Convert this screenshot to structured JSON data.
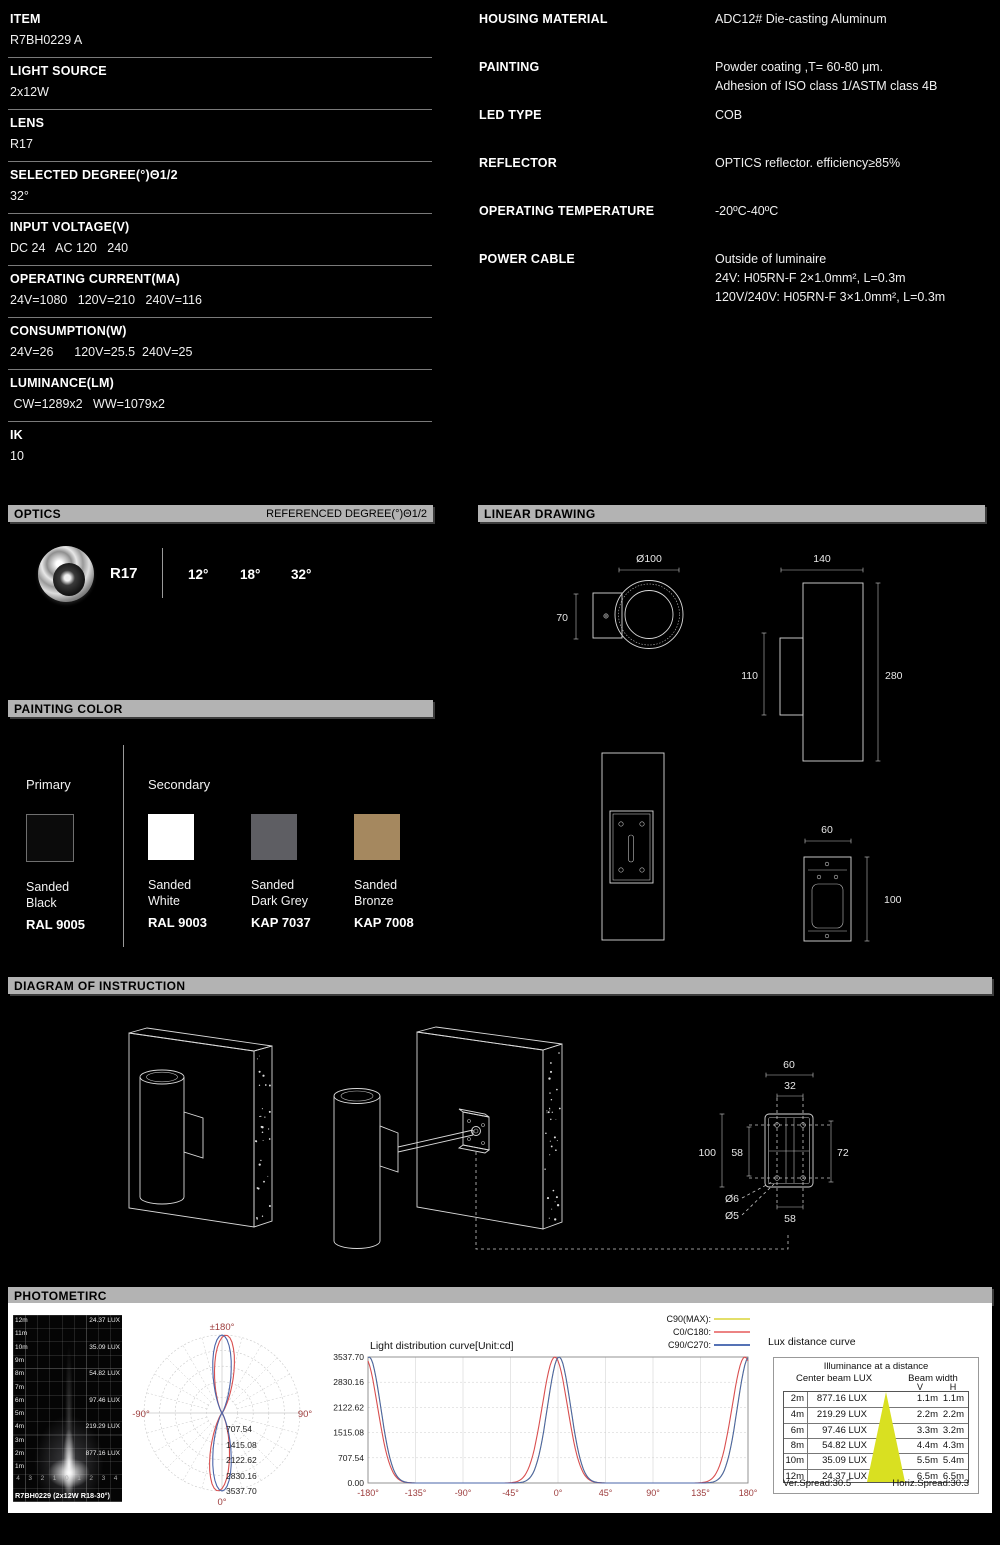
{
  "specs_left": [
    {
      "label": "ITEM",
      "value": "R7BH0229 A"
    },
    {
      "label": "LIGHT SOURCE",
      "value": "2x12W"
    },
    {
      "label": "LENS",
      "value": "R17"
    },
    {
      "label": "SELECTED DEGREE(°)Θ1/2",
      "value": "32°"
    },
    {
      "label": "INPUT VOLTAGE(V)",
      "value": "DC 24   AC 120   240"
    },
    {
      "label": "OPERATING CURRENT(MA)",
      "value": "24V=1080   120V=210   240V=116"
    },
    {
      "label": "CONSUMPTION(W)",
      "value": "24V=26      120V=25.5  240V=25"
    },
    {
      "label": "LUMINANCE(LM)",
      "value": " CW=1289x2   WW=1079x2"
    },
    {
      "label": "IK",
      "value": "10"
    }
  ],
  "specs_right": [
    {
      "label": "HOUSING MATERIAL",
      "lines": [
        "ADC12# Die-casting Aluminum"
      ]
    },
    {
      "label": "PAINTING",
      "lines": [
        "Powder coating ,T= 60-80 μm.",
        "Adhesion of ISO class 1/ASTM class 4B"
      ]
    },
    {
      "label": "LED TYPE",
      "lines": [
        "COB"
      ]
    },
    {
      "label": "REFLECTOR",
      "lines": [
        "OPTICS reflector. efficiency≥85%"
      ]
    },
    {
      "label": "OPERATING TEMPERATURE",
      "lines": [
        "-20ºC-40ºC"
      ]
    },
    {
      "label": "POWER CABLE",
      "lines": [
        "Outside of luminaire",
        "24V: H05RN-F 2×1.0mm², L=0.3m",
        "120V/240V: H05RN-F 3×1.0mm², L=0.3m"
      ]
    }
  ],
  "optics": {
    "title": "OPTICS",
    "subtitle": "REFERENCED DEGREE(°)Θ1/2",
    "lens": "R17",
    "degrees": [
      "12°",
      "18°",
      "32°"
    ]
  },
  "linear_drawing": {
    "title": "LINEAR DRAWING",
    "dims": {
      "top_diameter": "Ø100",
      "top_height": "70",
      "side_width": "140",
      "side_body": "110",
      "side_height": "280",
      "bracket_width": "60",
      "bracket_height": "100"
    }
  },
  "painting_color": {
    "title": "PAINTING COLOR",
    "primary_label": "Primary",
    "secondary_label": "Secondary",
    "swatches": [
      {
        "name1": "Sanded",
        "name2": "Black",
        "code": "RAL 9005",
        "color": "#0b0b0b",
        "border": "#6f6f6f"
      },
      {
        "name1": "Sanded",
        "name2": "White",
        "code": "RAL 9003",
        "color": "#ffffff",
        "border": ""
      },
      {
        "name1": "Sanded",
        "name2": "Dark Grey",
        "code": "KAP 7037",
        "color": "#5e5e63",
        "border": ""
      },
      {
        "name1": "Sanded",
        "name2": "Bronze",
        "code": "KAP 7008",
        "color": "#a5885f",
        "border": ""
      }
    ]
  },
  "instruction": {
    "title": "DIAGRAM OF INSTRUCTION",
    "dims": {
      "w60": "60",
      "w32": "32",
      "h100": "100",
      "h58": "58",
      "h72": "72",
      "d6": "Ø6",
      "d5": "Ø5",
      "b58": "58"
    }
  },
  "photometric": {
    "title": "PHOTOMETIRC",
    "beam_image": {
      "distance_labels": [
        "12m",
        "11m",
        "10m",
        "9m",
        "8m",
        "7m",
        "6m",
        "5m",
        "4m",
        "3m",
        "2m",
        "1m"
      ],
      "lux_rows": [
        {
          "row": 0,
          "text": "24.37 LUX"
        },
        {
          "row": 2,
          "text": "35.09 LUX"
        },
        {
          "row": 4,
          "text": "54.82 LUX"
        },
        {
          "row": 6,
          "text": "97.46 LUX"
        },
        {
          "row": 8,
          "text": "219.29 LUX"
        },
        {
          "row": 10,
          "text": "877.16 LUX"
        }
      ],
      "scale_ticks": [
        "4",
        "3",
        "2",
        "1",
        "0",
        "1",
        "2",
        "3",
        "4"
      ],
      "caption": "R7BH0229 (2x12W  R18-30°)"
    }
  },
  "chart_data": [
    {
      "type": "line",
      "name": "polar-intensity-curve",
      "angle_labels": [
        "±180°",
        "-90°",
        "90°",
        "0°"
      ],
      "radial_ticks": [
        "707.54",
        "1415.08",
        "2122.62",
        "2830.16",
        "3537.70"
      ],
      "peak_cd": 3537.7,
      "beam_fwhm_deg": 30.5,
      "series": [
        {
          "name": "C0/C180",
          "color": "#d94f4f",
          "offset_deg": -3,
          "sigma": 17
        },
        {
          "name": "C90/C270",
          "color": "#4a64a8",
          "offset_deg": 0,
          "sigma": 16
        }
      ],
      "grid": "polar, dashed rings every 707.54 cd, spokes every 15°"
    },
    {
      "type": "line",
      "name": "light-distribution-curve",
      "title": "Light distribution curve[Unit:cd]",
      "x_ticks": [
        "-180°",
        "-135°",
        "-90°",
        "-45°",
        "0°",
        "45°",
        "90°",
        "135°",
        "180°"
      ],
      "y_ticks": [
        "3537.70",
        "2830.16",
        "2122.62",
        "1515.08",
        "707.54",
        "0.00"
      ],
      "xlim": [
        -180,
        180
      ],
      "ylim": [
        0,
        3537.7
      ],
      "peak_cd": 3537.7,
      "legend": [
        {
          "label": "C90(MAX):",
          "color": "#e3df6a"
        },
        {
          "label": "C0/C180:",
          "color": "#ec8383"
        },
        {
          "label": "C90/C270:",
          "color": "#5572b5"
        }
      ],
      "series": [
        {
          "name": "C90(MAX)",
          "color": "#e3df6a",
          "mu": 1,
          "sigma": 15.5
        },
        {
          "name": "C0/C180",
          "color": "#d94f4f",
          "mu": -3,
          "sigma": 17
        },
        {
          "name": "C90/C270",
          "color": "#4a64a8",
          "mu": 1,
          "sigma": 15.5
        }
      ],
      "shape": "peaks of 3537.70 cd at 0° and ±180°, near 0 cd from 45° to 135°"
    },
    {
      "type": "table",
      "name": "lux-distance-curve",
      "title": "Lux distance curve",
      "header1": "Illuminance at a distance",
      "col_headers": {
        "center": "Center beam LUX",
        "beam": "Beam width",
        "v": "V",
        "h": "H"
      },
      "rows": [
        [
          "2m",
          "877.16 LUX",
          "1.1m",
          "1.1m"
        ],
        [
          "4m",
          "219.29 LUX",
          "2.2m",
          "2.2m"
        ],
        [
          "6m",
          "97.46 LUX",
          "3.3m",
          "3.2m"
        ],
        [
          "8m",
          "54.82 LUX",
          "4.4m",
          "4.3m"
        ],
        [
          "10m",
          "35.09 LUX",
          "5.5m",
          "5.4m"
        ],
        [
          "12m",
          "24.37 LUX",
          "6.5m",
          "6.5m"
        ]
      ],
      "footer_left": "Ver.Spread:30.5",
      "footer_right": "Horiz.Spread:30.3",
      "triangle_color": "#d9e021"
    }
  ]
}
